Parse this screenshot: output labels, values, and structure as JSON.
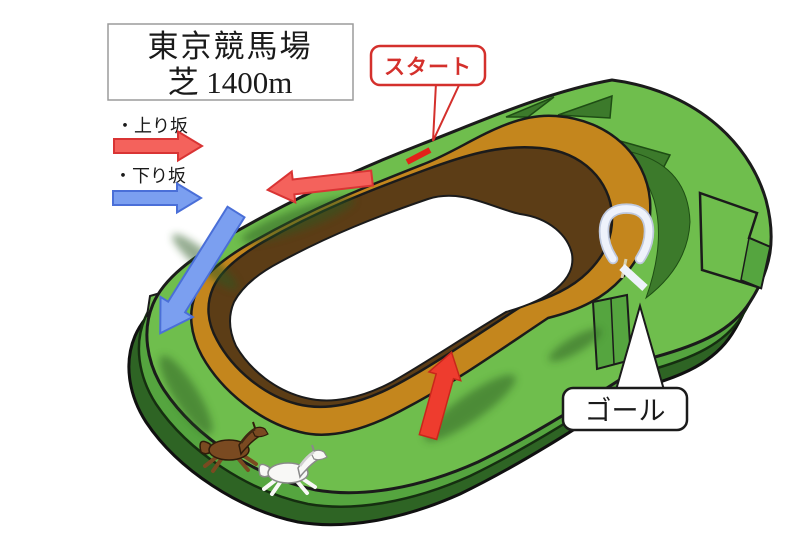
{
  "title": {
    "line1": "東京競馬場",
    "line2": "芝 1400m"
  },
  "callouts": {
    "start": "スタート",
    "goal": "ゴール"
  },
  "legend": {
    "uphill": "・上り坂",
    "downhill": "・下り坂"
  },
  "colors": {
    "background": "#ffffff",
    "turf_green": "#6fbe4d",
    "turf_green_side": "#55a53f",
    "turf_green_deep": "#2e6424",
    "turf_green_accent": "#3c7a2b",
    "dirt_orange": "#c4861d",
    "inner_bank_brown": "#5c3d16",
    "infield_white": "#ffffff",
    "uphill_red": "#f4625c",
    "uphill_red_border": "#d93434",
    "track_arrow_red": "#ee3c2e",
    "downhill_blue": "#7b9ff0",
    "downhill_blue_border": "#4a6fd8",
    "start_accent": "#d4302c",
    "start_line_red": "#e32119",
    "goal_marker_white": "#eef2fb",
    "outline_black": "#1b1b1b",
    "horse_brown": "#7a4a21",
    "horse_white": "#f8f8f6",
    "title_border_gray": "#9b9b9b",
    "text_black": "#1a1a1a"
  },
  "icons": {
    "goal_marker": "goal-post-icon",
    "horse_1": "brown-horse-icon",
    "horse_2": "white-horse-icon"
  }
}
